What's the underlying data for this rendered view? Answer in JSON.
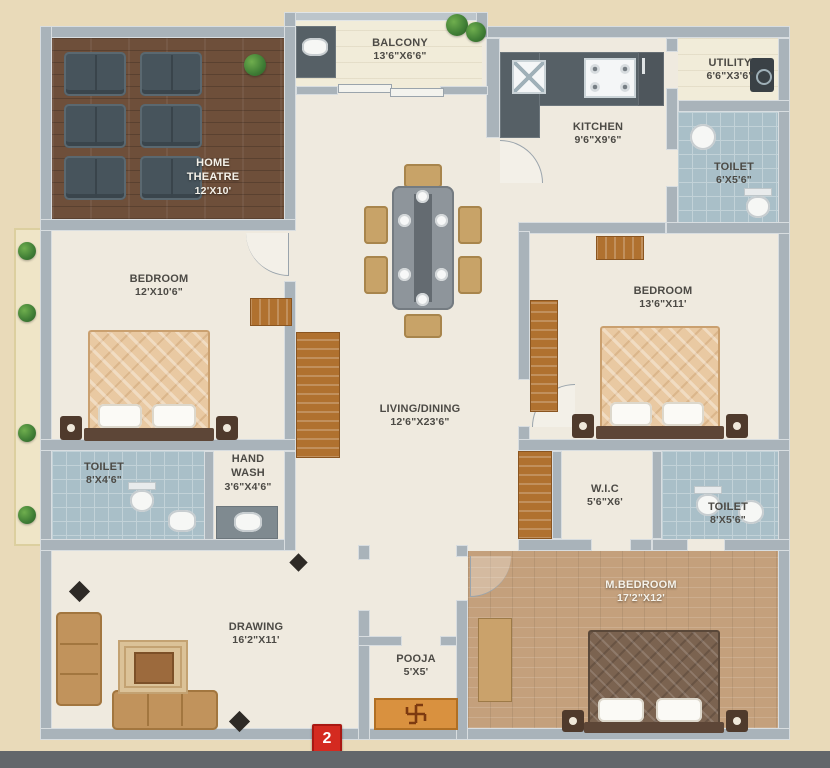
{
  "plan_title": "apartment-floor-plan",
  "marker": {
    "number": "2"
  },
  "rooms": {
    "balcony": {
      "name": "BALCONY",
      "size": "13'6\"X6'6\""
    },
    "home_theatre": {
      "name": "HOME THEATRE",
      "size": "12'X10'"
    },
    "kitchen": {
      "name": "KITCHEN",
      "size": "9'6\"X9'6\""
    },
    "utility": {
      "name": "UTILITY",
      "size": "6'6\"X3'6\""
    },
    "toilet_top_right": {
      "name": "TOILET",
      "size": "6'X5'6\""
    },
    "bedroom_left": {
      "name": "BEDROOM",
      "size": "12'X10'6\""
    },
    "bedroom_right": {
      "name": "BEDROOM",
      "size": "13'6\"X11'"
    },
    "living_dining": {
      "name": "LIVING/DINING",
      "size": "12'6\"X23'6\""
    },
    "toilet_bottom_left": {
      "name": "TOILET",
      "size": "8'X4'6\""
    },
    "hand_wash": {
      "name": "HAND WASH",
      "size": "3'6\"X4'6\""
    },
    "wic": {
      "name": "W.I.C",
      "size": "5'6\"X6'"
    },
    "toilet_bottom_right": {
      "name": "TOILET",
      "size": "8'X5'6\""
    },
    "drawing": {
      "name": "DRAWING",
      "size": "16'2\"X11'"
    },
    "pooja": {
      "name": "POOJA",
      "size": "5'X5'"
    },
    "m_bedroom": {
      "name": "M.BEDROOM",
      "size": "17'2\"X12'"
    }
  },
  "symbols": {
    "pooja_mat": "swastika"
  },
  "colors": {
    "background": "#e9dab9",
    "wall": "#a9b3ba",
    "floor": "#efeadf",
    "toilet_tile": "#a9bfc8",
    "wood_dark": "#6e4f3a",
    "wood_tan": "#c4a07c",
    "wardrobe": "#b0712f",
    "marker_red": "#d42a20"
  }
}
